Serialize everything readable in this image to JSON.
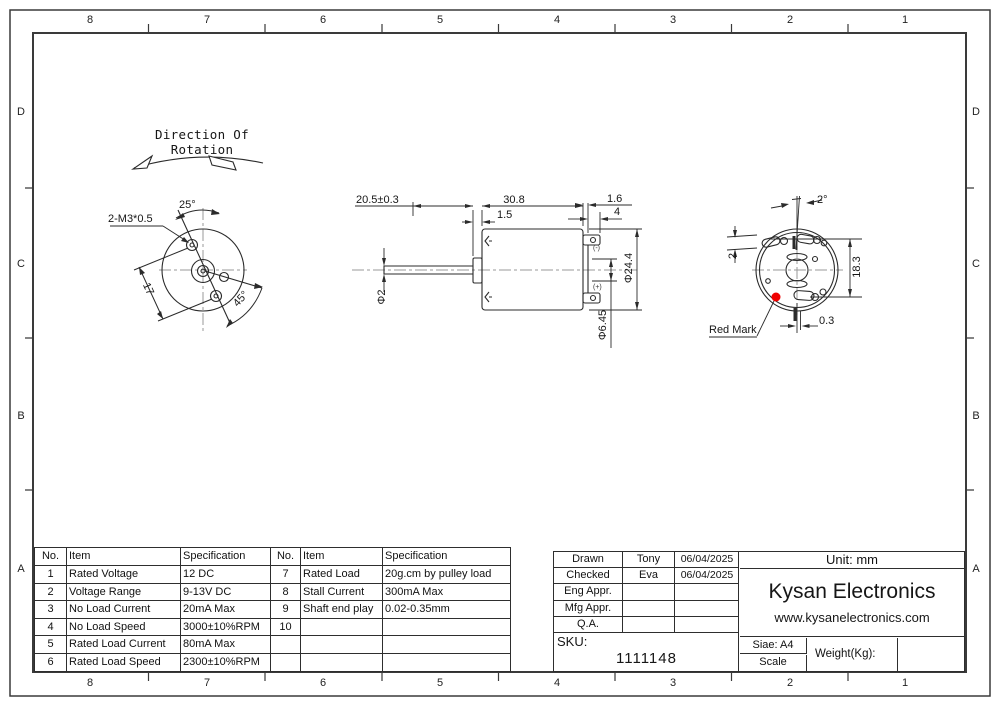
{
  "colors": {
    "line": "#2b2b2b",
    "centerline": "#9a9a9a",
    "red_mark": "#f00000"
  },
  "border": {
    "cols": [
      "8",
      "7",
      "6",
      "5",
      "4",
      "3",
      "2",
      "1"
    ],
    "rows": [
      "D",
      "C",
      "B",
      "A"
    ]
  },
  "front_view": {
    "heading": "Direction Of Rotation",
    "thread_label": "2-M3*0.5",
    "angle_top": "25°",
    "angle_bottom": "45°",
    "hole_spacing": "17"
  },
  "side_view": {
    "shaft_length": "20.5±0.3",
    "body_length": "30.8",
    "front_step": "1.5",
    "rear_step": "1.6",
    "terminal_length": "4",
    "shaft_dia": "Φ2",
    "body_dia": "Φ24.4",
    "terminal_span": "Φ6.45",
    "neg_terminal": "(-)",
    "pos_terminal": "(+)"
  },
  "rear_view": {
    "tilt_angle": "2°",
    "slot_width": "2",
    "slot_span": "18.3",
    "offset": "0.3",
    "red_mark_label": "Red Mark"
  },
  "spec_table": {
    "col_no": "No.",
    "col_item": "Item",
    "col_spec": "Specification",
    "left": [
      {
        "no": "1",
        "item": "Rated Voltage",
        "spec": "12 DC"
      },
      {
        "no": "2",
        "item": "Voltage Range",
        "spec": "9-13V DC"
      },
      {
        "no": "3",
        "item": "No Load Current",
        "spec": "20mA Max"
      },
      {
        "no": "4",
        "item": "No Load Speed",
        "spec": "3000±10%RPM"
      },
      {
        "no": "5",
        "item": "Rated Load Current",
        "spec": "80mA Max"
      },
      {
        "no": "6",
        "item": "Rated Load Speed",
        "spec": "2300±10%RPM"
      }
    ],
    "right": [
      {
        "no": "7",
        "item": "Rated Load",
        "spec": "20g.cm by pulley load"
      },
      {
        "no": "8",
        "item": "Stall Current",
        "spec": "300mA Max"
      },
      {
        "no": "9",
        "item": "Shaft end play",
        "spec": "0.02-0.35mm"
      },
      {
        "no": "10",
        "item": "",
        "spec": ""
      },
      {
        "no": "",
        "item": "",
        "spec": ""
      },
      {
        "no": "",
        "item": "",
        "spec": ""
      }
    ]
  },
  "title_block": {
    "rows": [
      {
        "label": "Drawn",
        "value": "Tony",
        "date": "06/04/2025"
      },
      {
        "label": "Checked",
        "value": "Eva",
        "date": "06/04/2025"
      },
      {
        "label": "Eng Appr.",
        "value": "",
        "date": ""
      },
      {
        "label": "Mfg Appr.",
        "value": "",
        "date": ""
      },
      {
        "label": "Q.A.",
        "value": "",
        "date": ""
      }
    ],
    "unit": "Unit: mm",
    "company": "Kysan Electronics",
    "website": "www.kysanelectronics.com",
    "sku_label": "SKU:",
    "sku_value": "1111148",
    "size": "Siae: A4",
    "scale_label": "Scale",
    "weight_label": "Weight(Kg):"
  }
}
